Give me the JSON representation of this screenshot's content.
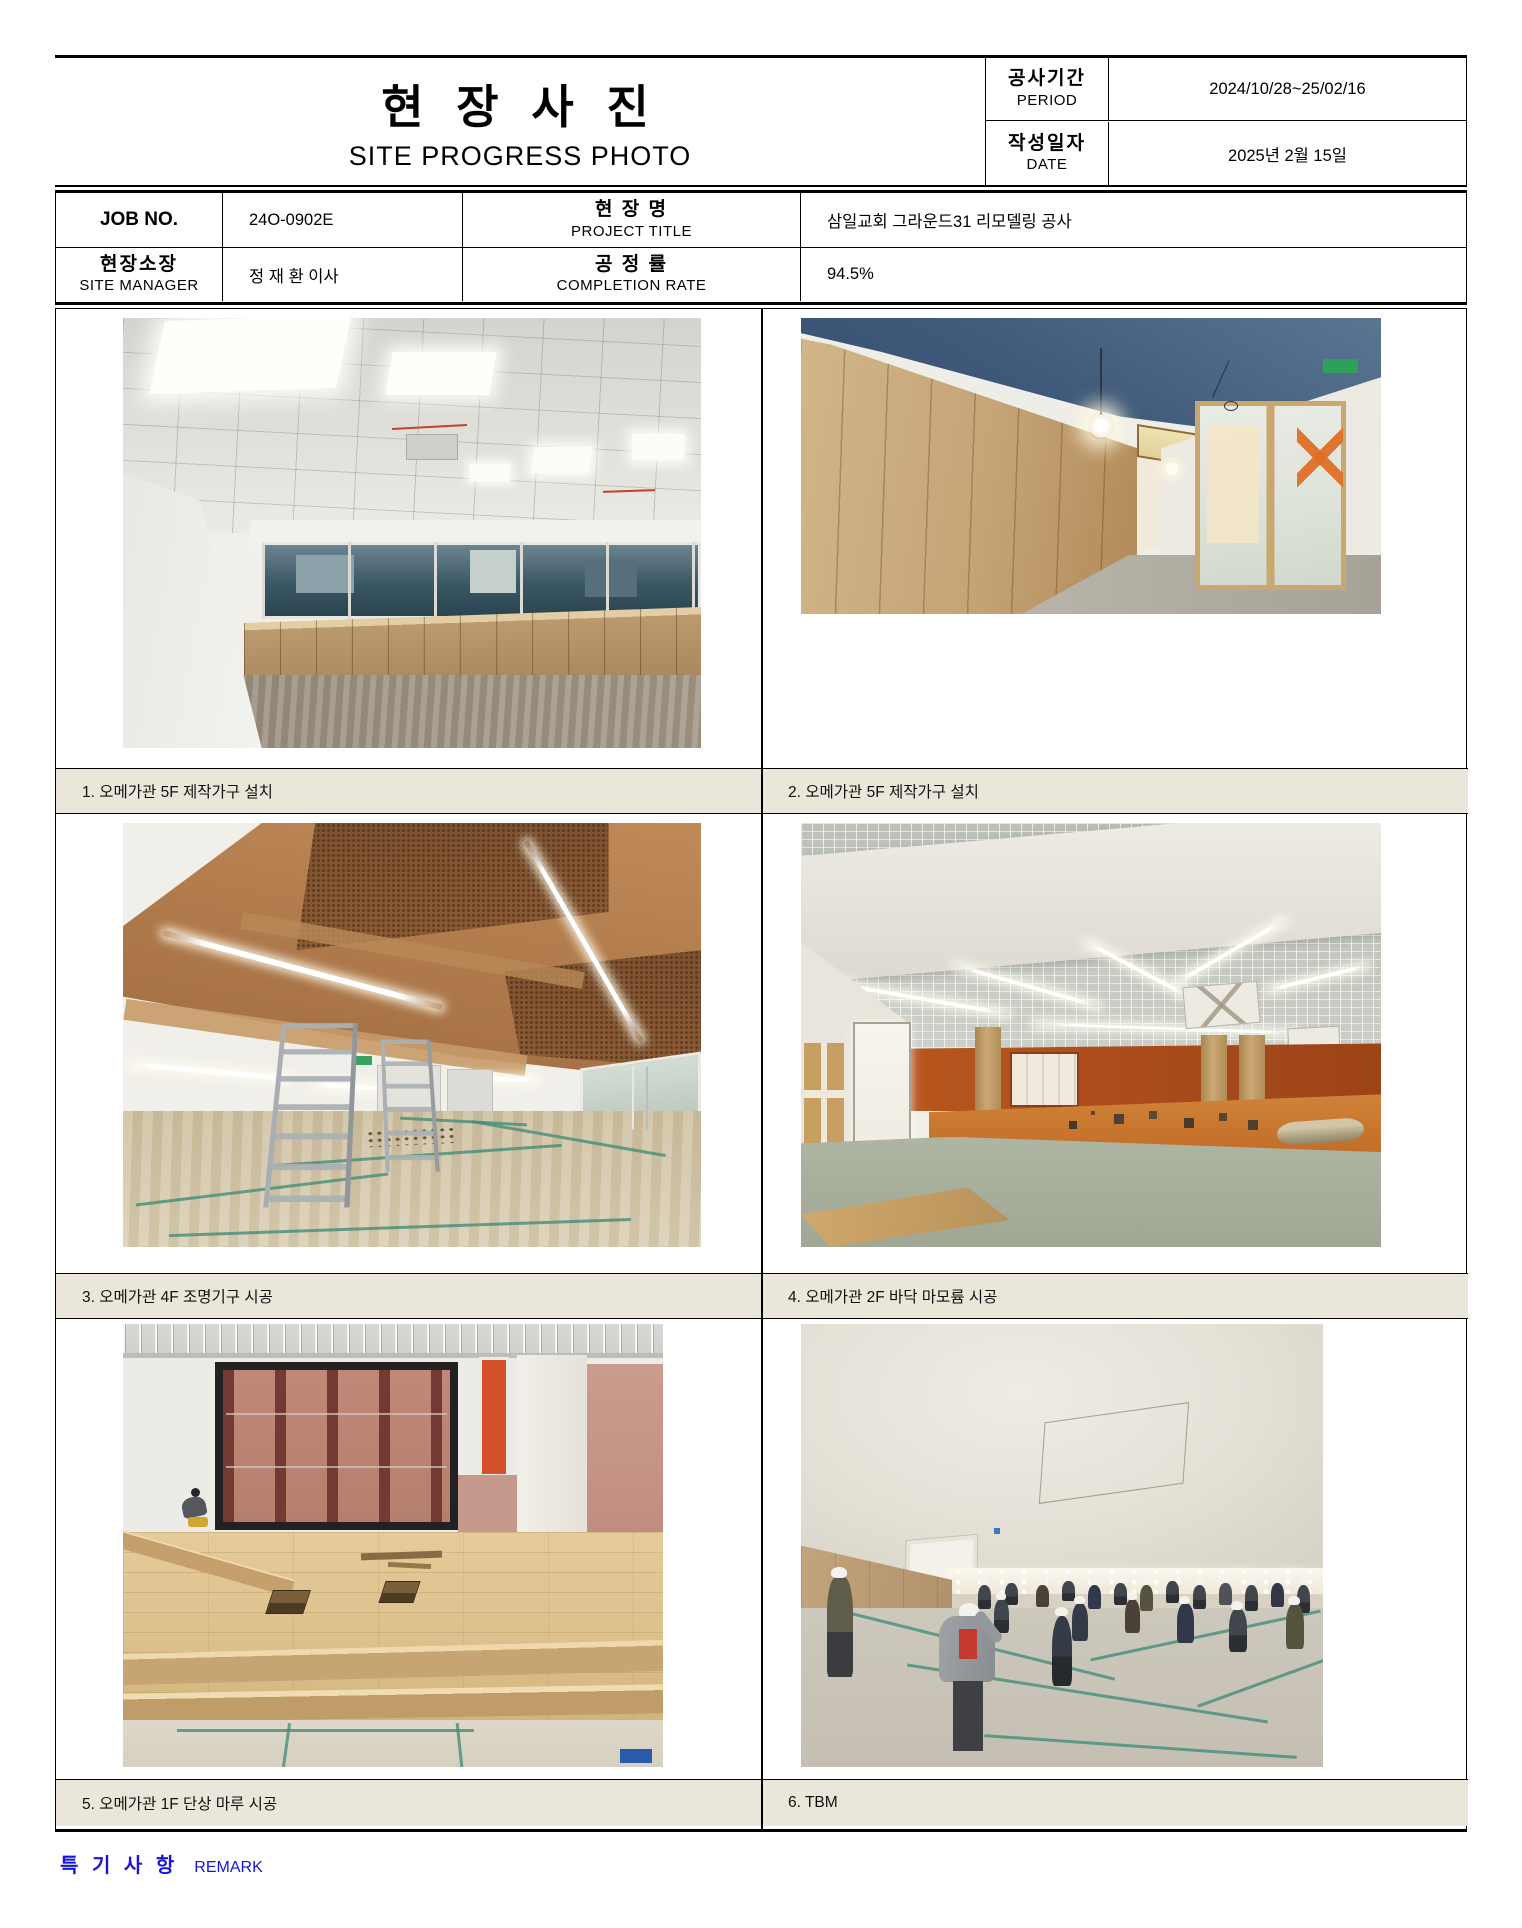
{
  "page": {
    "title": "현 장 사 진",
    "subtitle": "SITE PROGRESS PHOTO"
  },
  "header": {
    "period": {
      "label_ko": "공사기간",
      "label_en": "PERIOD",
      "value": "2024/10/28~25/02/16"
    },
    "date": {
      "label_ko": "작성일자",
      "label_en": "DATE",
      "value": "2025년 2월 15일"
    }
  },
  "info": {
    "job_no": {
      "label": "JOB NO.",
      "value": "24O-0902E"
    },
    "project": {
      "label_ko": "현 장 명",
      "label_en": "PROJECT TITLE",
      "value": "삼일교회 그라운드31 리모델링 공사"
    },
    "site_manager": {
      "label_ko": "현장소장",
      "label_en": "SITE MANAGER",
      "value": "정 재 환 이사"
    },
    "completion_rate": {
      "label_ko": "공 정 률",
      "label_en": "COMPLETION RATE",
      "value": "94.5%"
    }
  },
  "photos": [
    {
      "caption": "1. 오메가관 5F 제작가구 설치",
      "alt": "5F room with ceiling light panels, window band and built-in wood cabinets"
    },
    {
      "caption": "2. 오메가관 5F 제작가구 설치",
      "alt": "5F corridor with wood panel wall, dark blue ceiling, pendant lamp and glass doors"
    },
    {
      "caption": "3. 오메가관 4F 조명기구 시공",
      "alt": "4F exposed brown ceiling with suspended linear LED lights and step ladders"
    },
    {
      "caption": "4. 오메가관 2F 바닥 마모륨 시공",
      "alt": "2F hall with open grid ceiling, orange walls and marmoleum floor work"
    },
    {
      "caption": "5. 오메가관 1F 단상 마루 시공",
      "alt": "1F wooden stage platform flooring with framed wall opening and worker"
    },
    {
      "caption": "6. TBM",
      "alt": "Toolbox meeting of workers wearing white hard hats on protected floor"
    }
  ],
  "remark": {
    "label_ko": "특 기 사 항",
    "label_en": "REMARK"
  },
  "colors": {
    "caption_bg": "#EAE6DA",
    "remark_blue": "#1616DC",
    "border_black": "#000000"
  }
}
